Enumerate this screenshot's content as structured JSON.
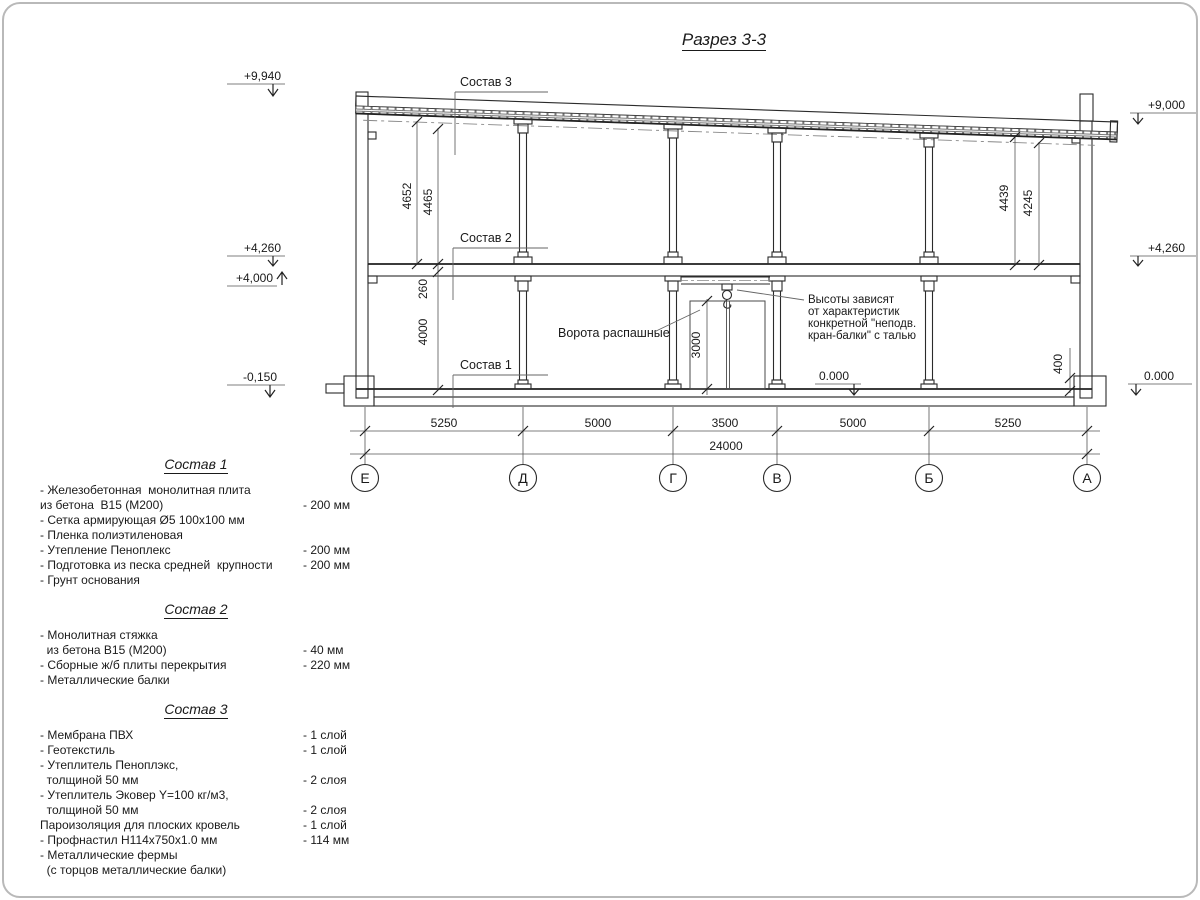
{
  "title": "Разрез 3-3",
  "drawing": {
    "callouts": {
      "sostav3": "Состав 3",
      "sostav2": "Состав 2",
      "sostav1": "Состав 1",
      "gates": "Ворота распашные",
      "crane_note": [
        "Высоты зависят",
        "от характеристик",
        "конкретной \"неподв.",
        "кран-балки\" с талью"
      ]
    },
    "elevations": {
      "left_top": "+9,940",
      "left_floor_top": "+4,260",
      "left_floor_bottom": "+4,000",
      "left_ground": "-0,150",
      "right_top": "+9,000",
      "right_floor": "+4,260",
      "right_ground": "0.000",
      "mid_ground": "0.000"
    },
    "vdims": {
      "left_outer": "4652",
      "left_inner": "4465",
      "slab": "260",
      "storey": "4000",
      "right_outer": "4439",
      "right_inner": "4245",
      "door": "3000",
      "plinth": "400"
    },
    "hdims": {
      "spans": [
        "5250",
        "5000",
        "3500",
        "5000",
        "5250"
      ],
      "total": "24000"
    },
    "axes": [
      "Е",
      "Д",
      "Г",
      "В",
      "Б",
      "А"
    ]
  },
  "legend": {
    "sections": [
      {
        "heading": "Состав 1",
        "lines": [
          {
            "t": "- Железобетонная  монолитная плита",
            "v": ""
          },
          {
            "t": "из бетона  В15 (М200)",
            "v": "- 200 мм"
          },
          {
            "t": "- Сетка армирующая Ø5 100х100 мм",
            "v": ""
          },
          {
            "t": "- Пленка полиэтиленовая",
            "v": ""
          },
          {
            "t": "- Утепление Пеноплекс",
            "v": "- 200 мм"
          },
          {
            "t": "- Подготовка из песка средней  крупности",
            "v": "- 200 мм"
          },
          {
            "t": "- Грунт основания",
            "v": ""
          }
        ]
      },
      {
        "heading": "Состав 2",
        "lines": [
          {
            "t": "- Монолитная стяжка",
            "v": ""
          },
          {
            "t": "  из бетона В15 (М200)",
            "v": "- 40 мм"
          },
          {
            "t": "- Сборные ж/б плиты перекрытия",
            "v": "- 220 мм"
          },
          {
            "t": "- Металлические балки",
            "v": ""
          }
        ]
      },
      {
        "heading": "Состав 3",
        "lines": [
          {
            "t": "- Мембрана ПВХ",
            "v": "- 1 слой"
          },
          {
            "t": "- Геотекстиль",
            "v": "- 1 слой"
          },
          {
            "t": "- Утеплитель Пеноплэкс,",
            "v": ""
          },
          {
            "t": "  толщиной 50 мм",
            "v": "- 2 слоя"
          },
          {
            "t": "- Утеплитель Эковер Y=100 кг/м3,",
            "v": ""
          },
          {
            "t": "  толщиной 50 мм",
            "v": "- 2 слоя"
          },
          {
            "t": "Пароизоляция для плоских кровель",
            "v": "- 1 слой"
          },
          {
            "t": "- Профнастил Н114х750х1.0 мм",
            "v": "- 114 мм"
          },
          {
            "t": "- Металлические фермы",
            "v": ""
          },
          {
            "t": "  (с торцов металлические балки)",
            "v": ""
          }
        ]
      }
    ]
  }
}
